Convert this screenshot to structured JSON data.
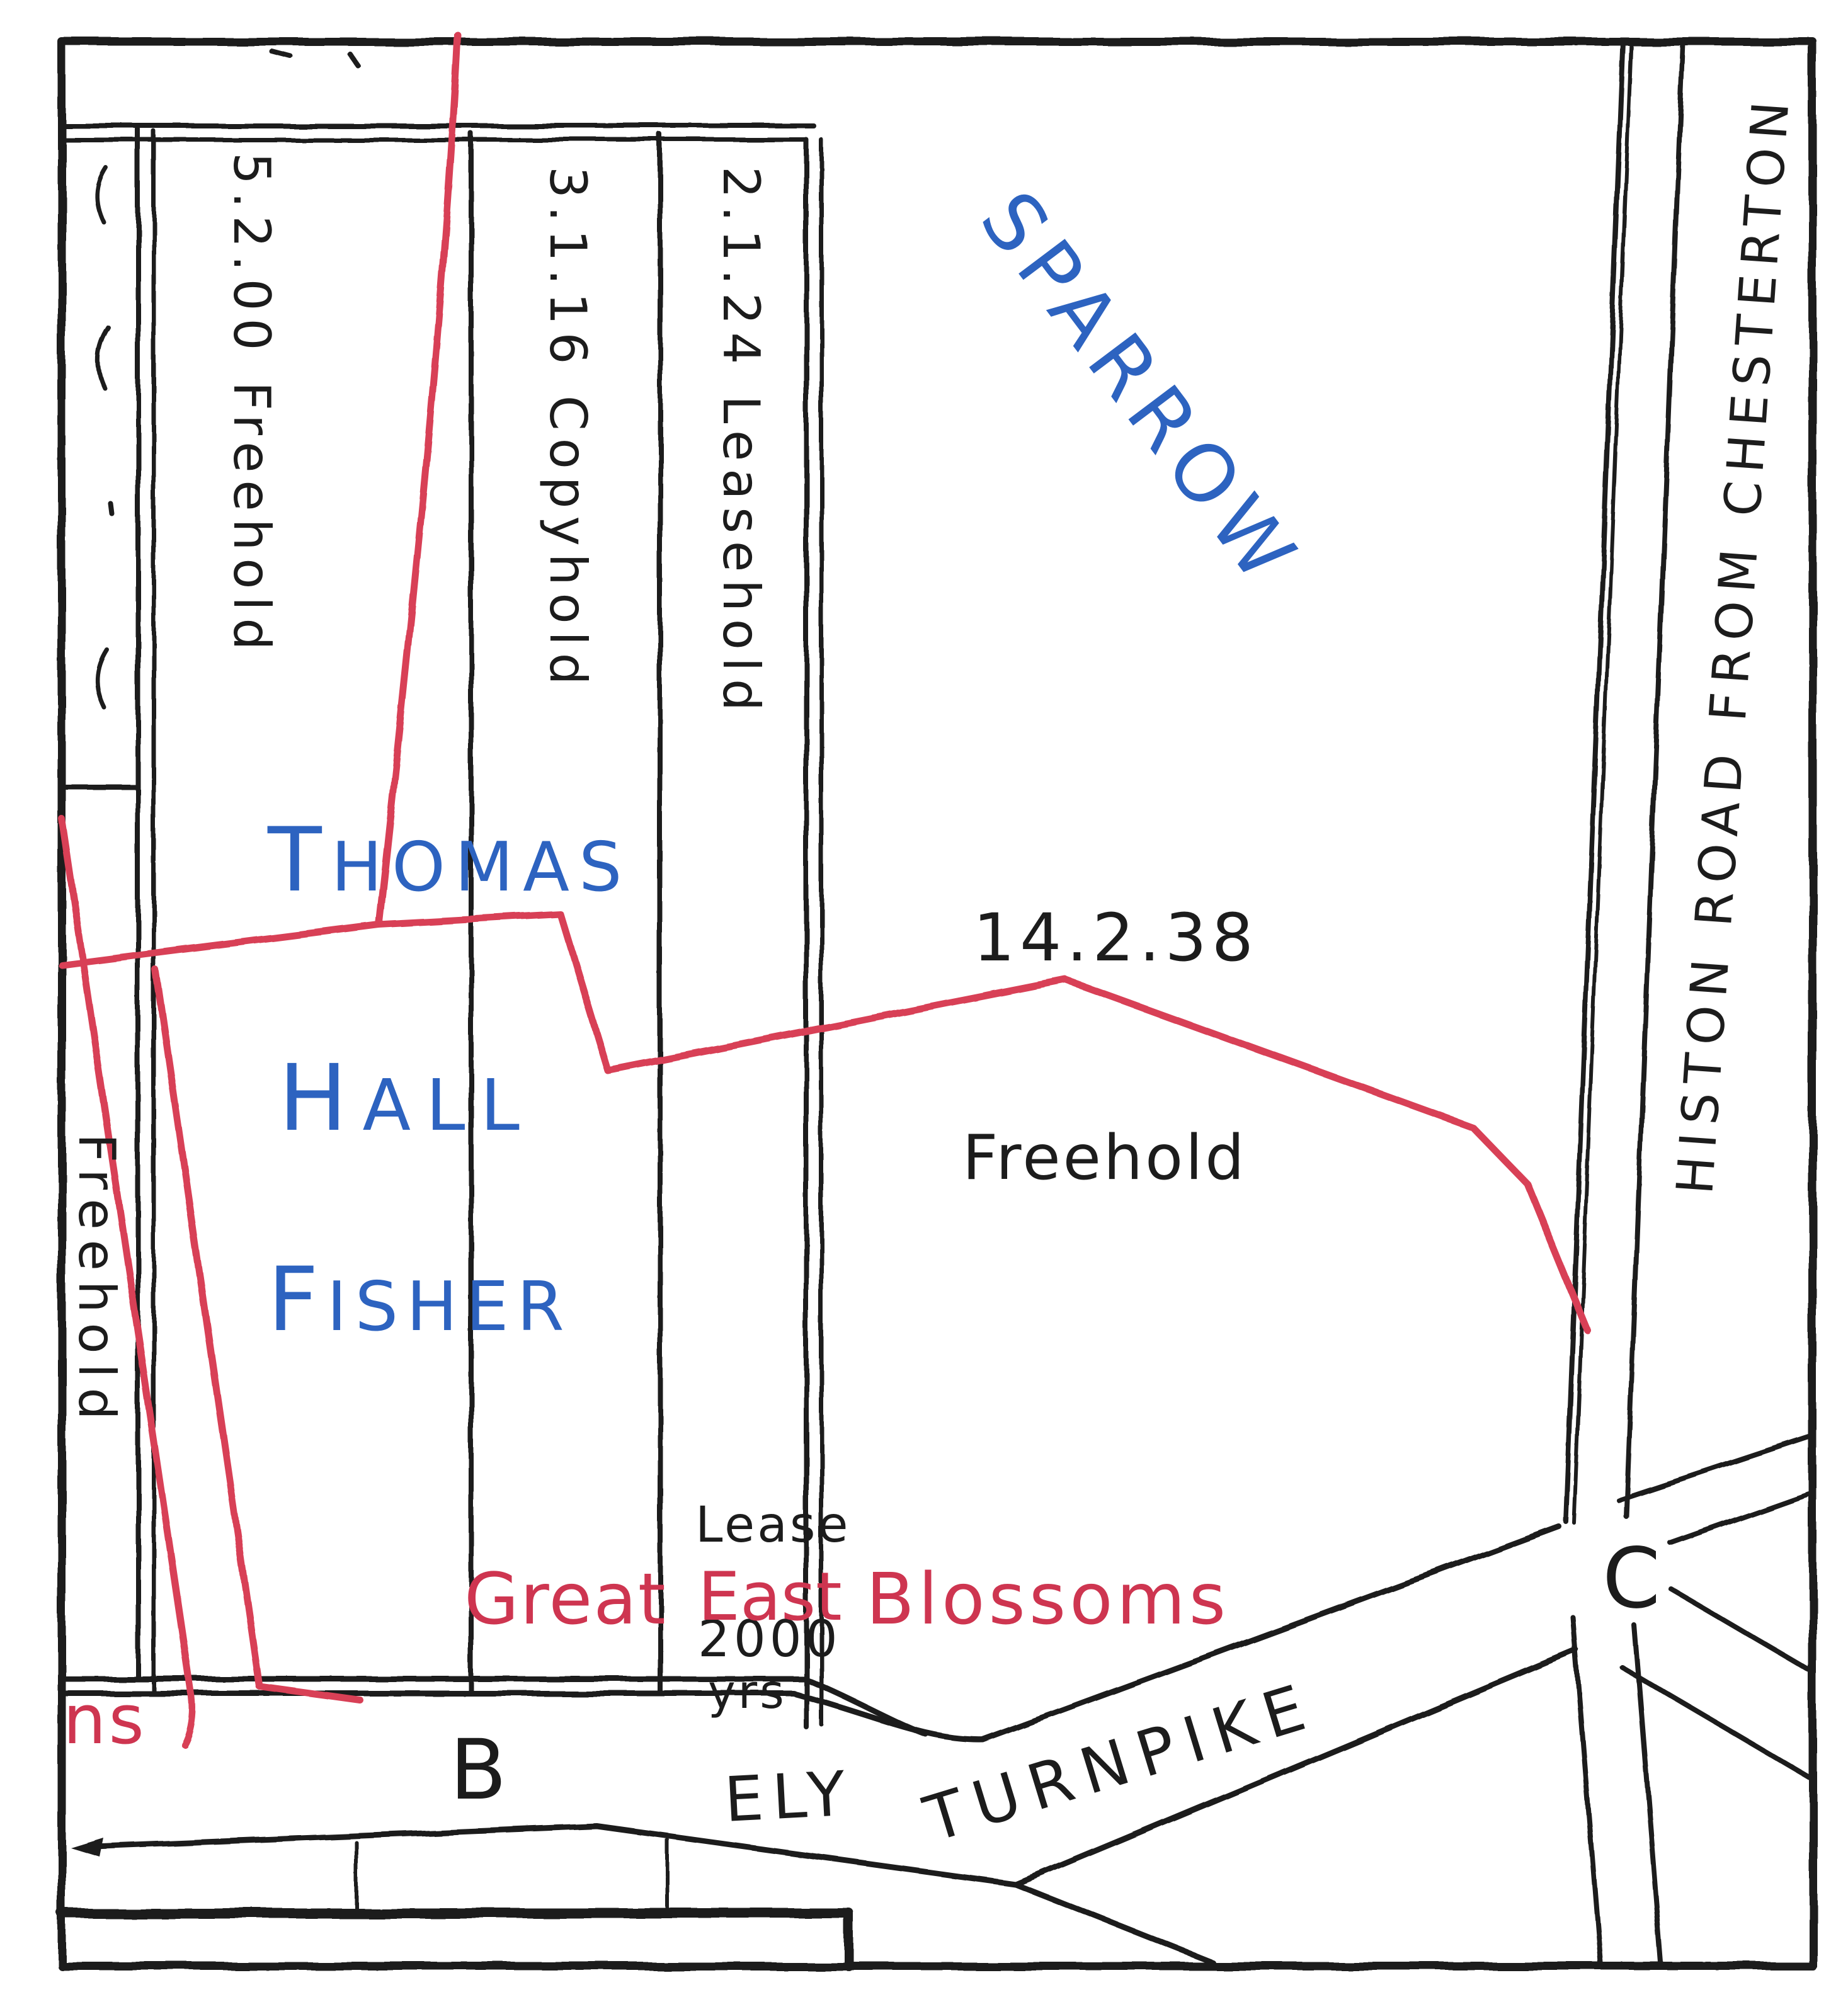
{
  "fields": {
    "north_field_name": "SPARROW",
    "north_field_area": "14.2.38",
    "north_field_tenure": "Freehold",
    "owner_line1": "THOMAS",
    "owner_line2": "HALL",
    "owner_line3": "FISHER"
  },
  "strips": [
    {
      "label": "5.2.00 Freehold"
    },
    {
      "label": "3.1.16 Copyhold"
    },
    {
      "label": "2.1.24 Leasehold"
    }
  ],
  "left_strip": {
    "tenure_label": "Freehold",
    "red_fragment": "ns"
  },
  "lease_note": {
    "word": "Lease",
    "term": "2000",
    "term_unit": "yrs"
  },
  "red_field_name": {
    "word1": "Great",
    "word2": "East",
    "word3": "Blossoms"
  },
  "roads": {
    "ely": "ELY",
    "turnpike": "TURNPIKE",
    "histon": "HISTON ROAD FROM CHESTERTON"
  },
  "markers": {
    "b": "B",
    "c": "C"
  },
  "colors": {
    "boundary_red": "#d84057",
    "red_text": "#ce3550",
    "ink_blue": "#2d63c0",
    "ink_black": "#1c1c1c"
  }
}
